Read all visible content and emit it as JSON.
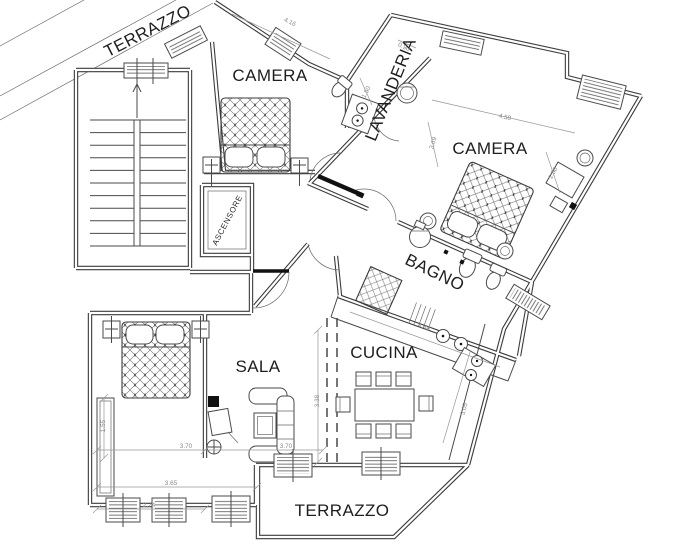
{
  "plan": {
    "type": "apartment-floor-plan",
    "background": "#ffffff",
    "line_color": "#3b3b3b"
  },
  "rooms": {
    "camera_top": {
      "label": "CAMERA"
    },
    "camera_right": {
      "label": "CAMERA"
    },
    "lavanderia": {
      "label": "LAVANDERIA"
    },
    "bagno": {
      "label": "BAGNO"
    },
    "cucina": {
      "label": "CUCINA"
    },
    "sala": {
      "label": "SALA"
    },
    "terrazzo_bottom": {
      "label": "TERRAZZO"
    },
    "terrazzo_top": {
      "label": "TERRAZZO"
    },
    "ascensore": {
      "label": "ASCENSORE"
    }
  },
  "dimensions": [
    {
      "value": "4.16"
    },
    {
      "value": "4.58"
    },
    {
      "value": "3.69"
    },
    {
      "value": "1.50"
    },
    {
      "value": "0.90"
    },
    {
      "value": "1.50"
    },
    {
      "value": "4.48"
    },
    {
      "value": "3.05"
    },
    {
      "value": "3.70"
    },
    {
      "value": "3.70"
    },
    {
      "value": "3.65"
    },
    {
      "value": "2.74"
    },
    {
      "value": "1.55"
    },
    {
      "value": "3.38"
    }
  ]
}
